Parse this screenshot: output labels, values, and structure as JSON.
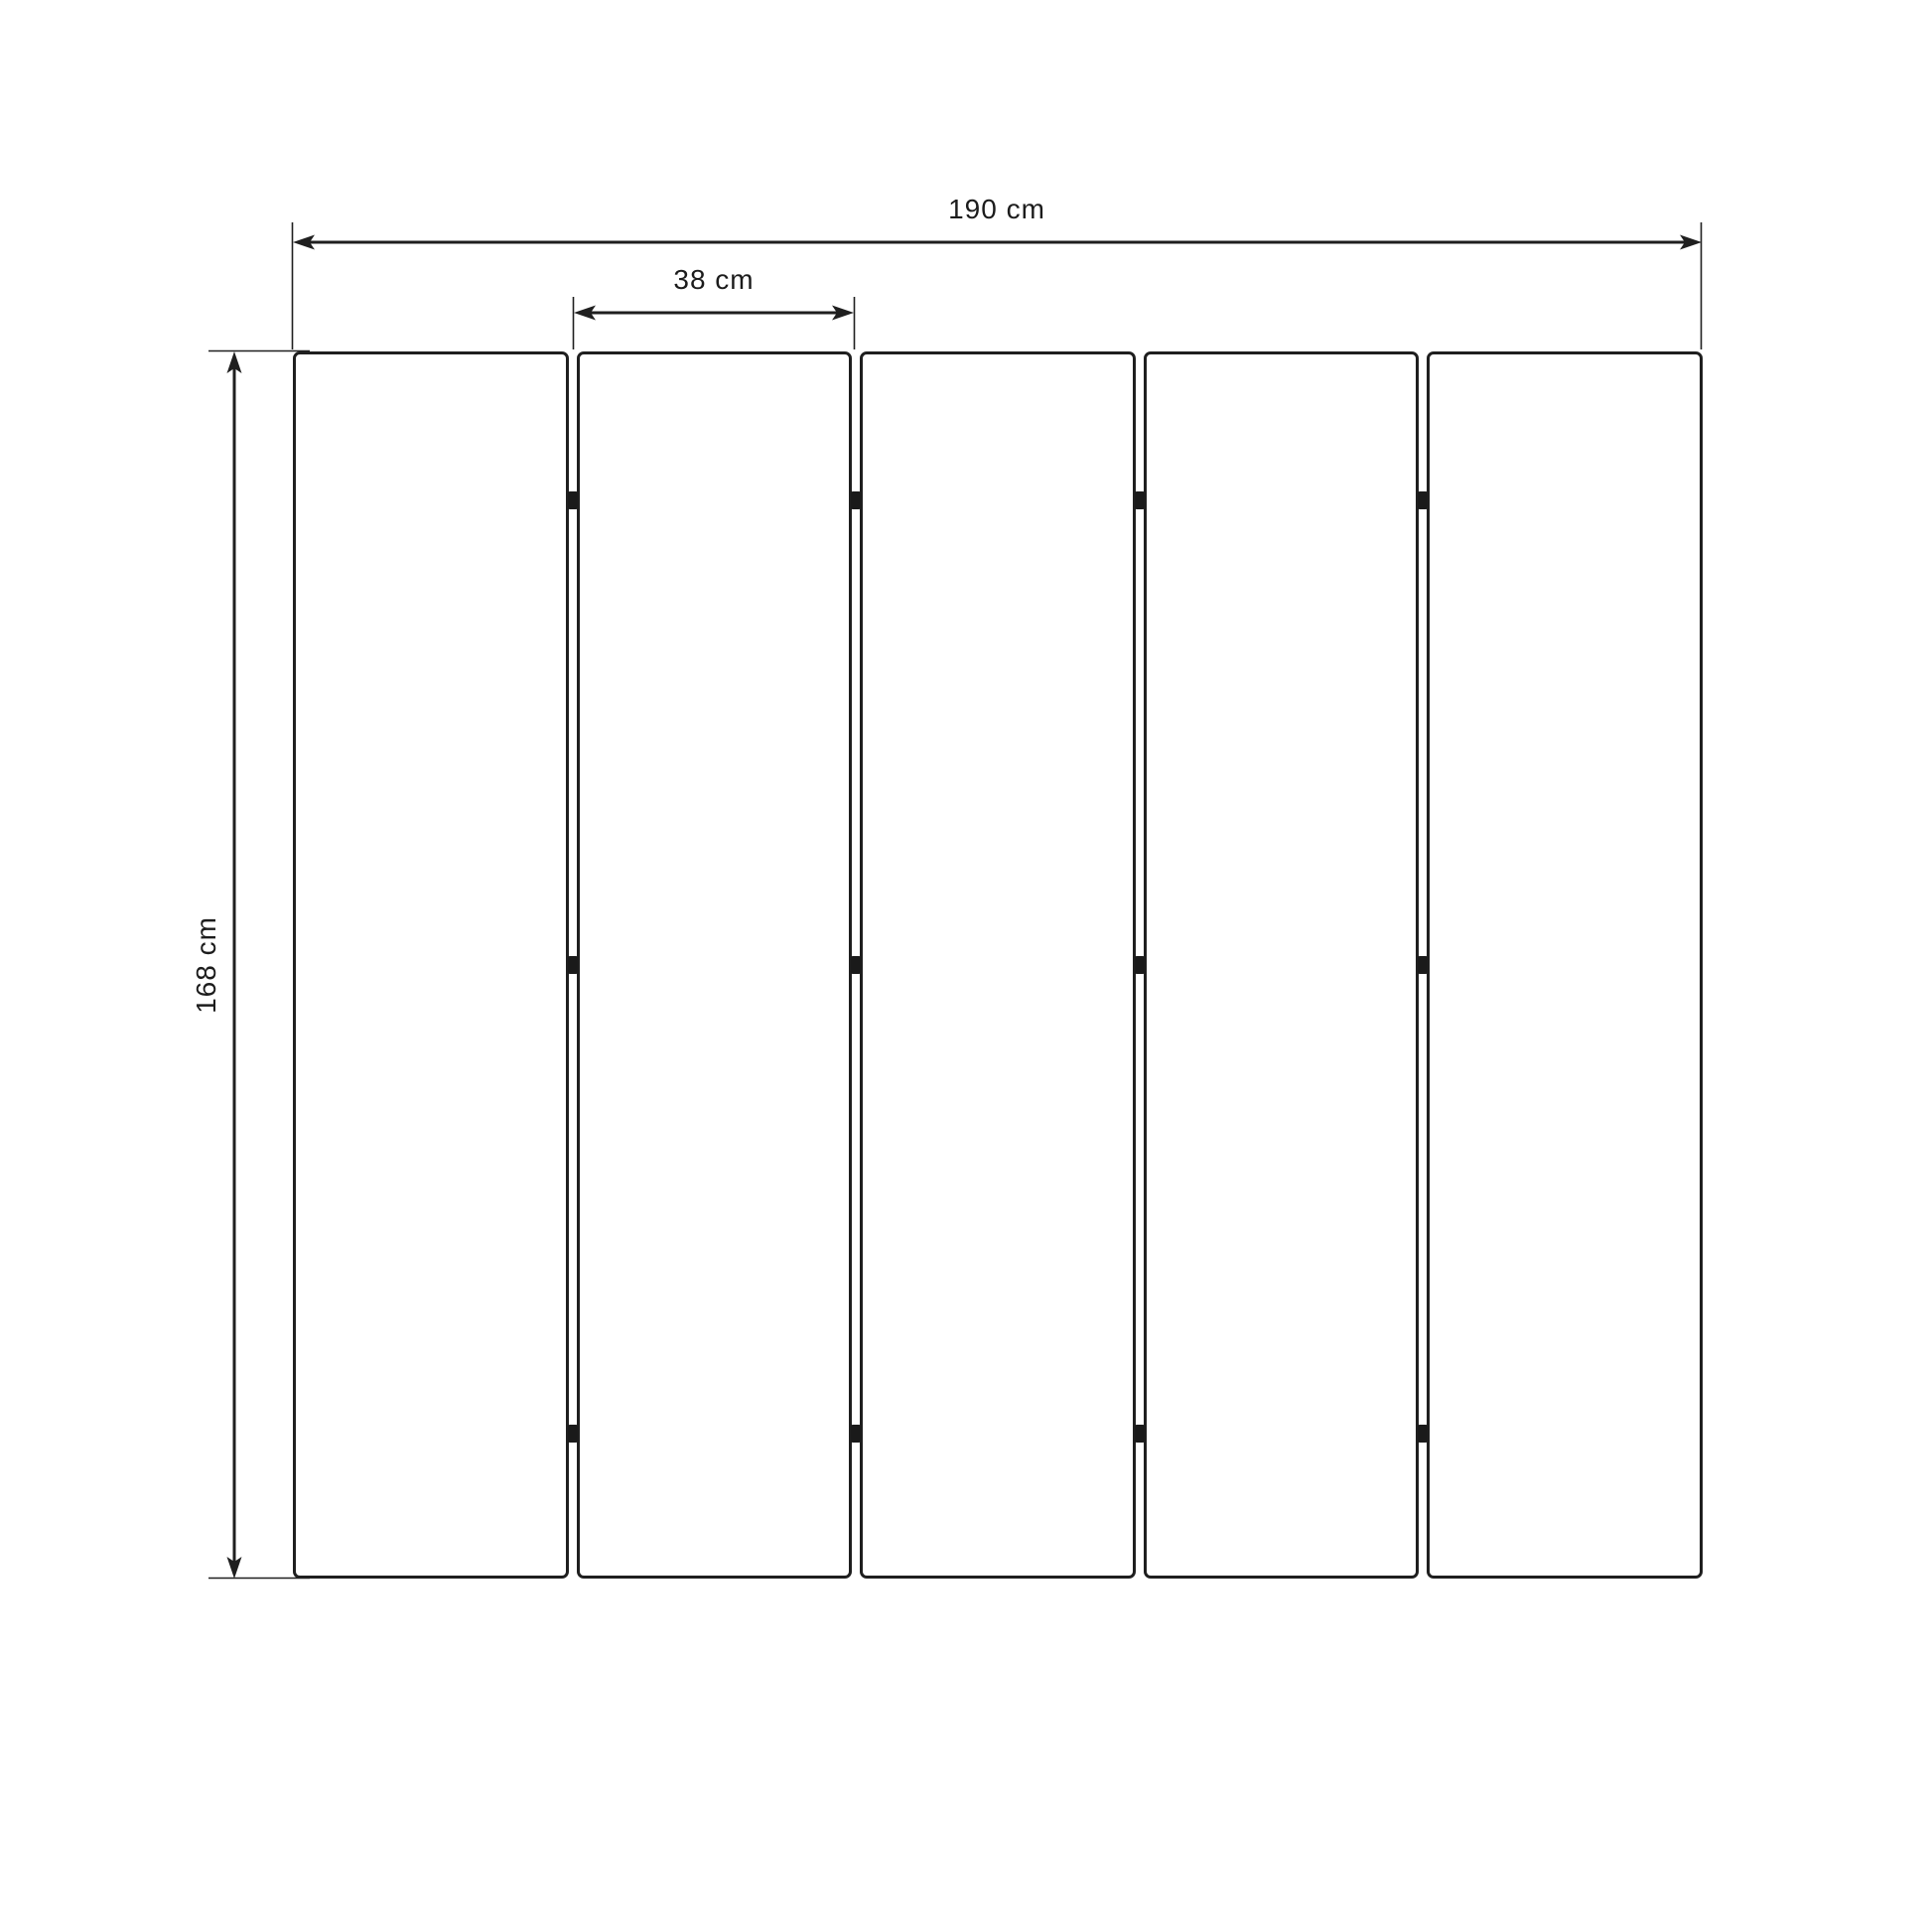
{
  "diagram": {
    "type": "dimension-drawing",
    "subject": "five-panel folding screen, front elevation",
    "panel_count": 5,
    "hinges_per_joint": 3,
    "joint_count": 4,
    "dimensions": {
      "total_width": {
        "label": "190 cm",
        "value": 190,
        "unit": "cm"
      },
      "panel_width": {
        "label": "38 cm",
        "value": 38,
        "unit": "cm"
      },
      "height": {
        "label": "168 cm",
        "value": 168,
        "unit": "cm"
      }
    },
    "colors": {
      "line": "#1f1f1f",
      "hinge": "#1a1a1a",
      "text": "#1c1c1c",
      "background": "#ffffff"
    }
  }
}
